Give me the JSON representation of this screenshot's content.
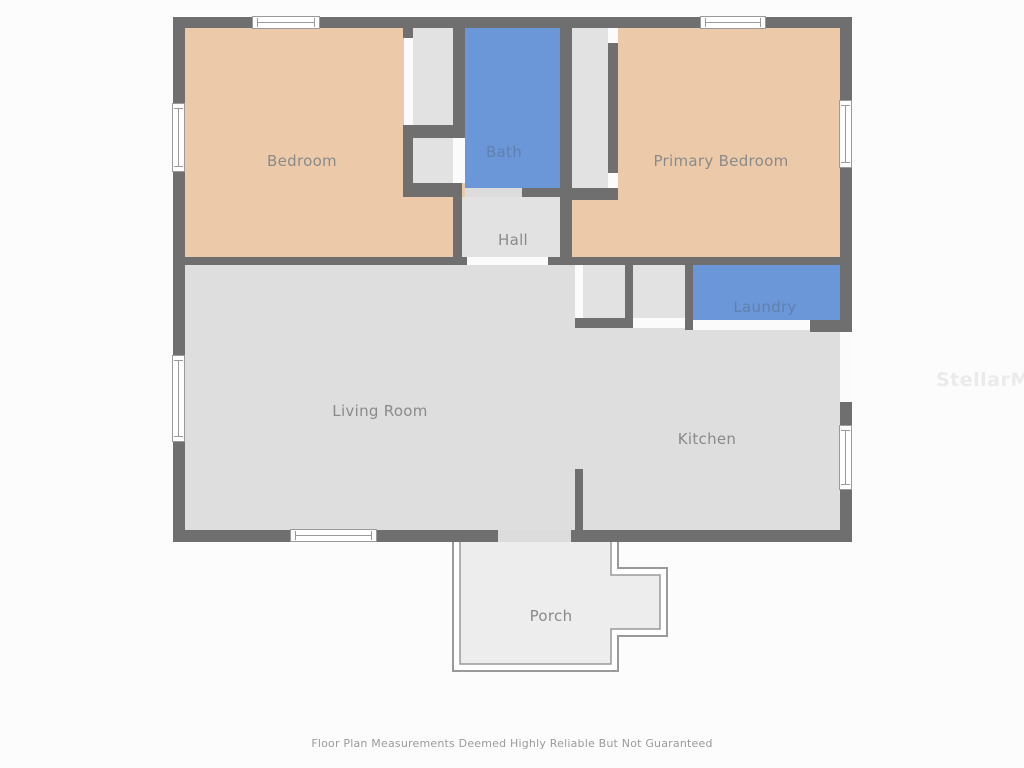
{
  "rooms": {
    "bedroom": {
      "label": "Bedroom"
    },
    "bath": {
      "label": "Bath"
    },
    "primary_bedroom": {
      "label": "Primary Bedroom"
    },
    "hall": {
      "label": "Hall"
    },
    "laundry": {
      "label": "Laundry"
    },
    "living_room": {
      "label": "Living Room"
    },
    "kitchen": {
      "label": "Kitchen"
    },
    "porch": {
      "label": "Porch"
    }
  },
  "footer": {
    "disclaimer": "Floor Plan Measurements Deemed Highly Reliable But Not Guaranteed"
  },
  "watermark": {
    "text": "StellarMLS"
  },
  "colors": {
    "wall": "#6f6f6f",
    "bedroom_fill": "#eccaa9",
    "wet_room_fill": "#6b97d9",
    "floor_fill": "#dedede",
    "closet_fill": "#e2e2e2",
    "porch_fill": "#ededed",
    "background": "#fcfcfc",
    "label_text": "#8a8a8a",
    "label_text_on_blue": "#6180ae",
    "window_line": "#9a9a9a",
    "watermark_text": "#ebebeb",
    "disclaimer_text": "#9b9b9b"
  }
}
